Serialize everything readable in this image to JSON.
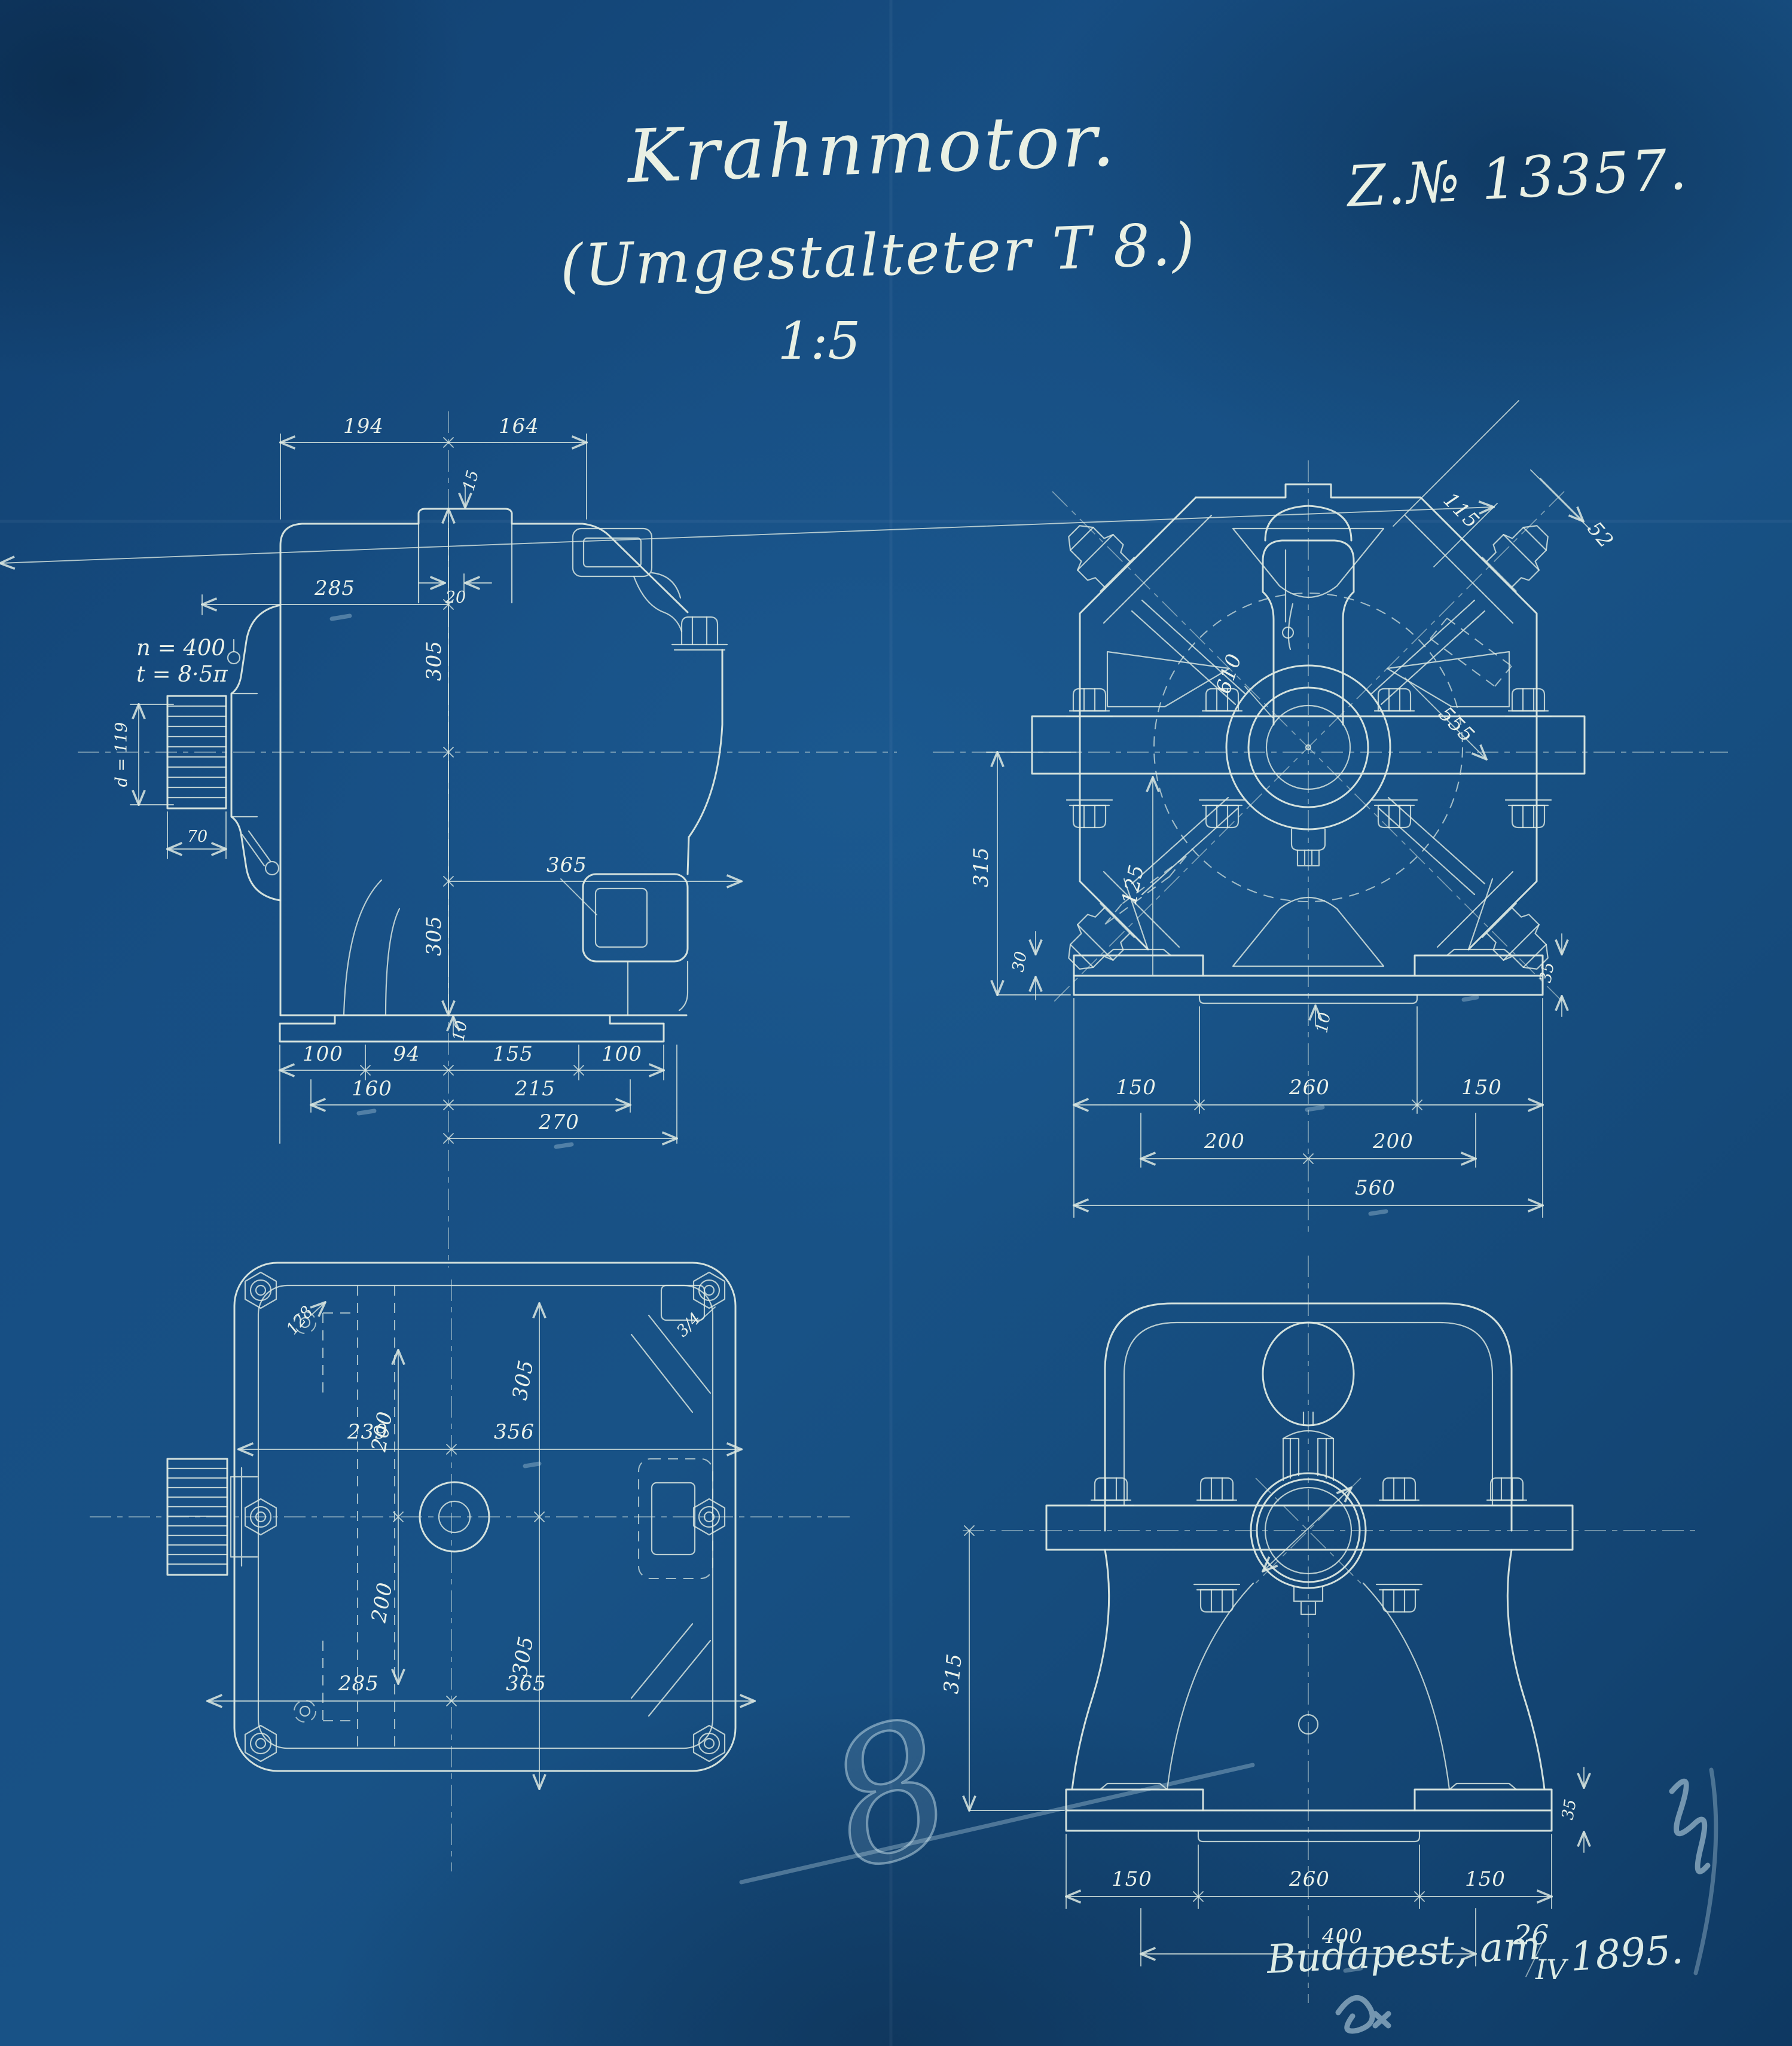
{
  "sheet": {
    "background": "#174e83",
    "line_color": "#dde9e2",
    "chalk_color": "#d8eef5"
  },
  "title_block": {
    "title": "Krahnmotor.",
    "subtitle": "(Umgestalteter T 8.)",
    "scale": "1:5",
    "drawing_number": "Z.№ 13357."
  },
  "footer": {
    "place_line": "Budapest, am",
    "date_day": "26",
    "date_month": "IV",
    "date_year": "1895."
  },
  "chalk": {
    "numeral": "8"
  },
  "views": {
    "side": {
      "notes": {
        "n": "n = 400",
        "t": "t = 8·5π",
        "pinion_dia": "d = 119"
      },
      "dims": {
        "w194": "194",
        "w164": "164",
        "h15": "15",
        "w20": "20",
        "w285": "285",
        "h305_top": "305",
        "h305_bot": "305",
        "w365": "365",
        "w70": "70",
        "h10": "10",
        "w100l": "100",
        "w94": "94",
        "w155": "155",
        "w100r": "100",
        "w160": "160",
        "w215": "215",
        "w270": "270"
      }
    },
    "front": {
      "dims": {
        "d115": "115",
        "d52": "52",
        "d610": "610",
        "d555": "555",
        "h125": "125",
        "h315": "315",
        "h30": "30",
        "h10": "10",
        "w150l": "150",
        "w260": "260",
        "w150r": "150",
        "w200l": "200",
        "w200r": "200",
        "w560": "560",
        "h35": "35"
      }
    },
    "plan": {
      "notes": {
        "hole_dia": "128",
        "bolt_size": "3/4"
      },
      "dims": {
        "w239": "239",
        "w356": "356",
        "h305_top": "305",
        "h200_top": "200",
        "h200_bot": "200",
        "w285": "285",
        "w365": "365",
        "h305_bot": "305"
      }
    },
    "rear": {
      "notes": {
        "shaft_dia": "d=119"
      },
      "dims": {
        "h315": "315",
        "w150l": "150",
        "w260": "260",
        "w150r": "150",
        "w400": "400",
        "h35": "35"
      }
    }
  }
}
